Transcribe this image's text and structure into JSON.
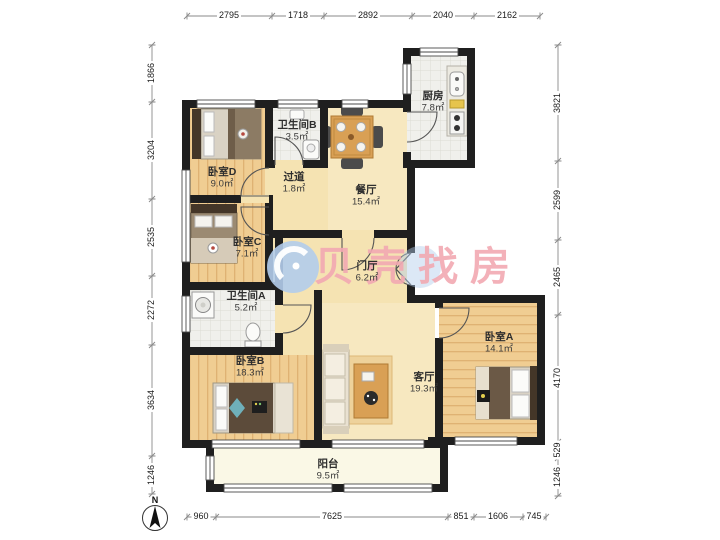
{
  "plan": {
    "watermark_text": "贝壳找房",
    "compass_label": "N"
  },
  "rooms": [
    {
      "name": "厨房",
      "area": "7.8㎡"
    },
    {
      "name": "卫生间B",
      "area": "3.5㎡"
    },
    {
      "name": "过道",
      "area": "1.8㎡"
    },
    {
      "name": "餐厅",
      "area": "15.4㎡"
    },
    {
      "name": "卧室D",
      "area": "9.0㎡"
    },
    {
      "name": "卧室C",
      "area": "7.1㎡"
    },
    {
      "name": "门厅",
      "area": "6.2㎡"
    },
    {
      "name": "卫生间A",
      "area": "5.2㎡"
    },
    {
      "name": "卧室B",
      "area": "18.3㎡"
    },
    {
      "name": "客厅",
      "area": "19.3㎡"
    },
    {
      "name": "卧室A",
      "area": "14.1㎡"
    },
    {
      "name": "阳台",
      "area": "9.5㎡"
    }
  ],
  "dimensions_mm": {
    "top": [
      "2795",
      "1718",
      "2892",
      "2040",
      "2162"
    ],
    "left": [
      "1866",
      "3204",
      "2535",
      "2272",
      "3634",
      "1246"
    ],
    "right": [
      "3821",
      "2599",
      "2465",
      "4170",
      "529",
      "1246"
    ],
    "bottom": [
      "960",
      "7625",
      "851",
      "1606",
      "745"
    ]
  },
  "colors": {
    "wall": "#1f1f1f",
    "wood_floor": "#f0cd92",
    "warm_floor": "#f5e3b2",
    "tile_floor": "#f0f0ec",
    "balcony_floor": "#faf8e6",
    "watermark_pink": "#f2a9b2",
    "watermark_blue": "#b2cceb"
  }
}
